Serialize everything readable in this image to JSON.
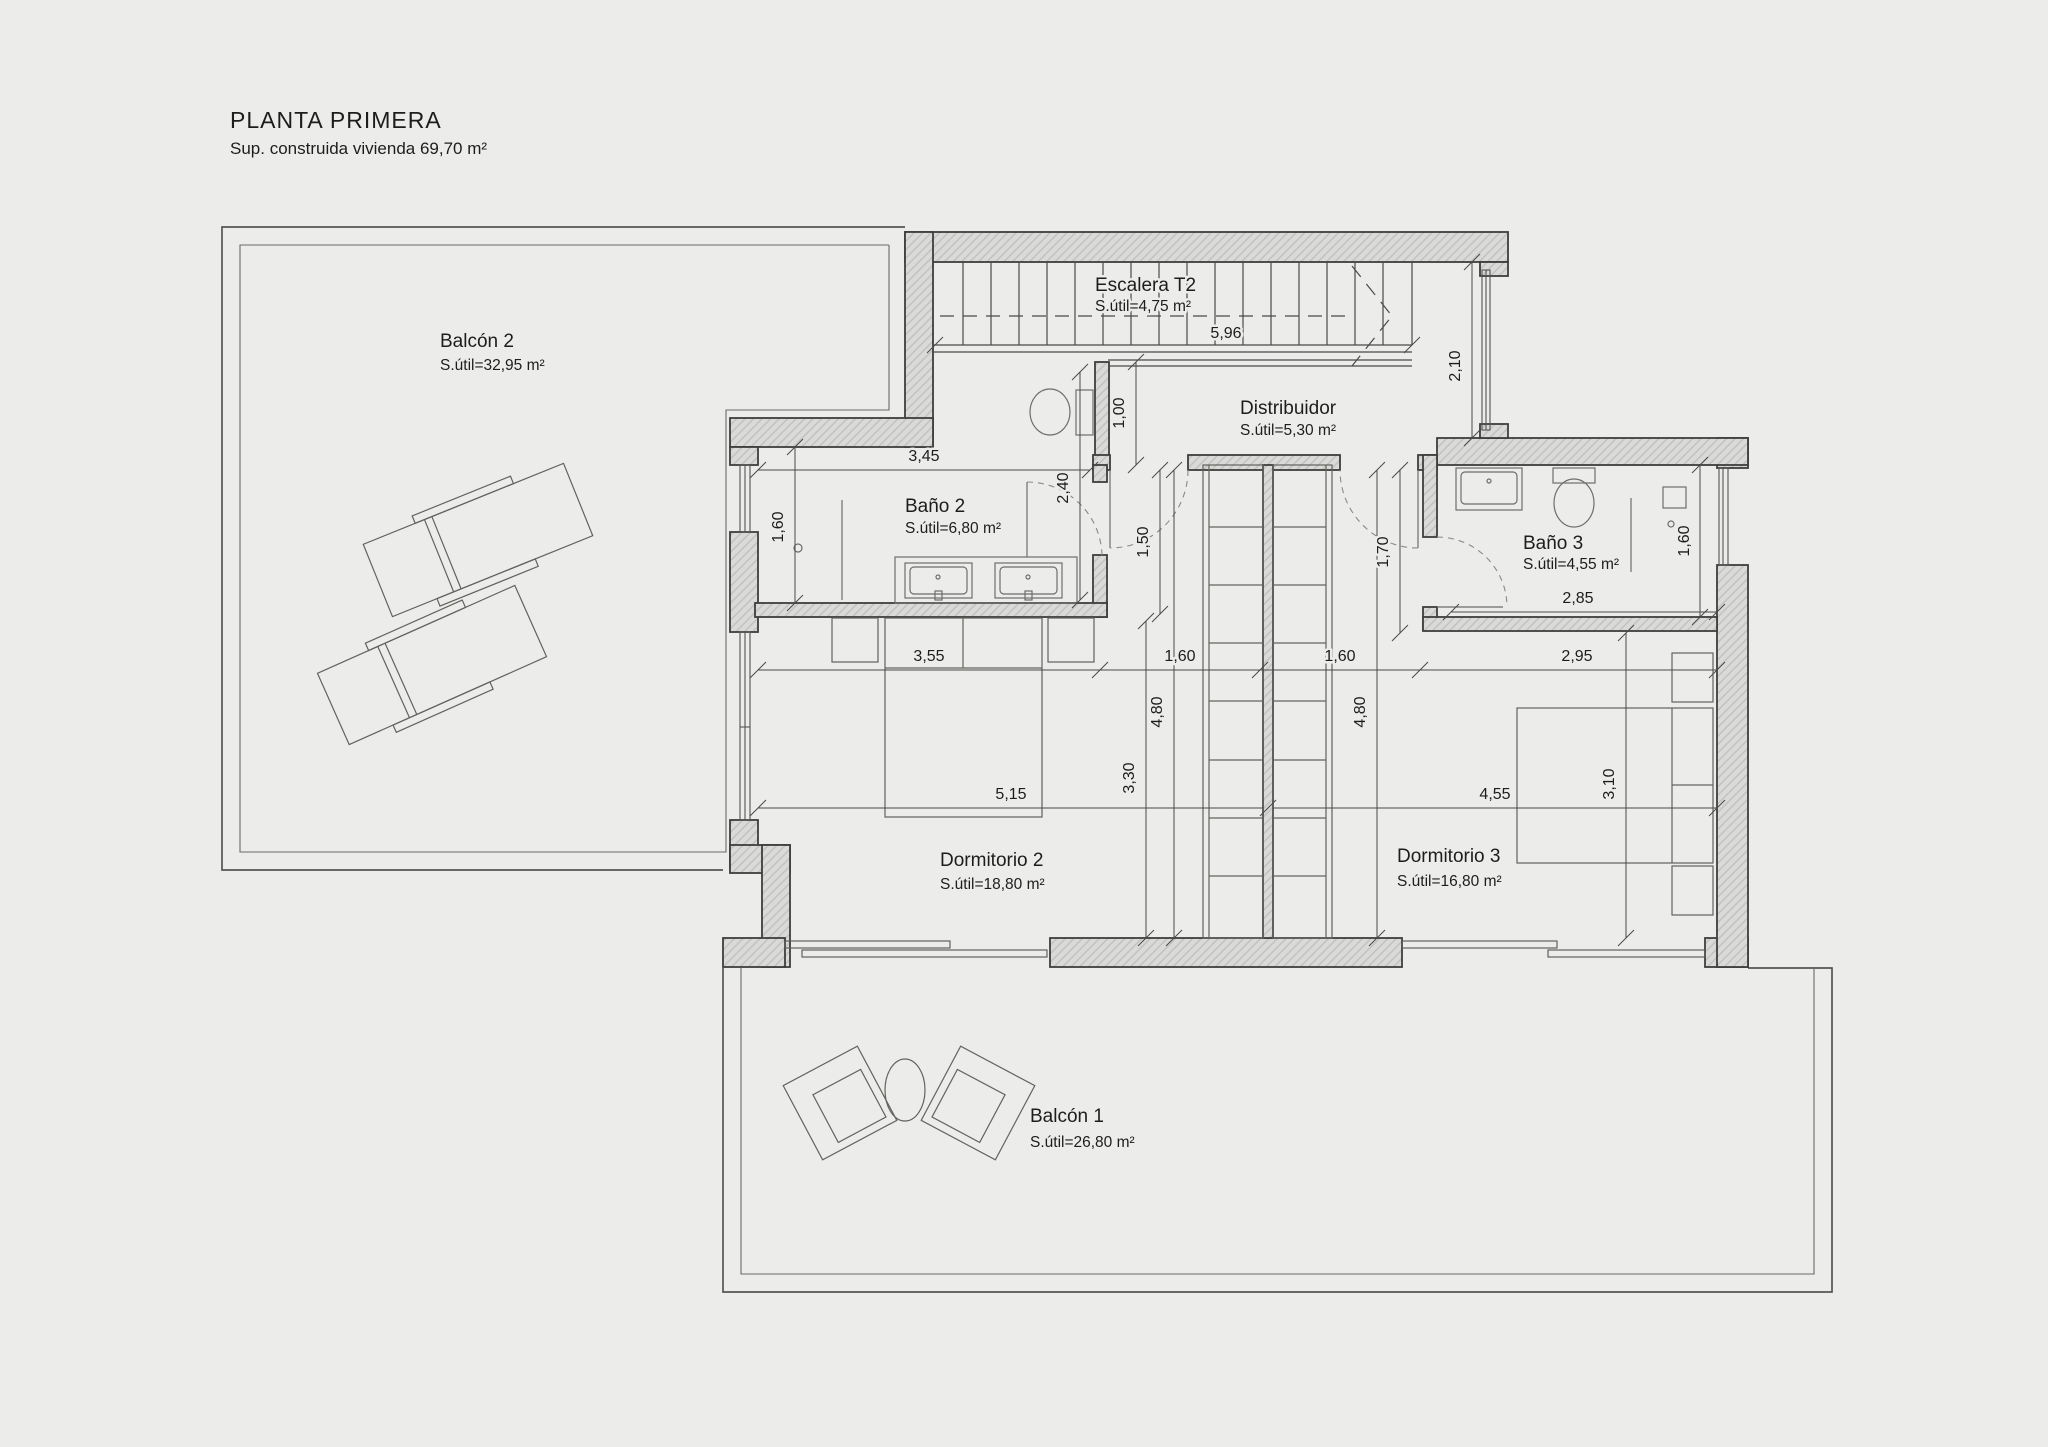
{
  "title": {
    "main": "PLANTA PRIMERA",
    "subtitle": "Sup. construida vivienda 69,70 m²"
  },
  "rooms": {
    "balcon2": {
      "name": "Balcón 2",
      "area": "S.útil=32,95 m²"
    },
    "escalera": {
      "name": "Escalera T2",
      "area": "S.útil=4,75 m²"
    },
    "distribuidor": {
      "name": "Distribuidor",
      "area": "S.útil=5,30 m²"
    },
    "bano2": {
      "name": "Baño 2",
      "area": "S.útil=6,80 m²"
    },
    "bano3": {
      "name": "Baño 3",
      "area": "S.útil=4,55 m²"
    },
    "dormitorio2": {
      "name": "Dormitorio 2",
      "area": "S.útil=18,80 m²"
    },
    "dormitorio3": {
      "name": "Dormitorio 3",
      "area": "S.útil=16,80 m²"
    },
    "balcon1": {
      "name": "Balcón 1",
      "area": "S.útil=26,80 m²"
    }
  },
  "dimensions": {
    "stair_length": "5,96",
    "hall_neck": "1,00",
    "right_corridor": "2,10",
    "bano2_width": "3,45",
    "bano2_depth": "1,60",
    "bano2_nook": "2,40",
    "hall_door": "1,50",
    "dorm3_entry": "1,70",
    "bano3_width": "2,85",
    "bano3_depth": "1,60",
    "dorm2_width": "3,55",
    "wardrobe_left": "1,60",
    "wardrobe_right": "1,60",
    "dorm3_width": "2,95",
    "dorm2_depth": "4,80",
    "dorm3_depth": "4,80",
    "dorm2_inner_depth": "3,30",
    "dorm3_inner_depth": "3,10",
    "dorm2_length": "5,15",
    "dorm3_length": "4,55"
  },
  "colors": {
    "background": "#ececea",
    "wall_fill": "#dadad8",
    "wall_hatch": "#c0c0be",
    "wall_line": "#3e3e3c",
    "dim_line": "#4a4a48",
    "text": "#1d1d1b"
  }
}
